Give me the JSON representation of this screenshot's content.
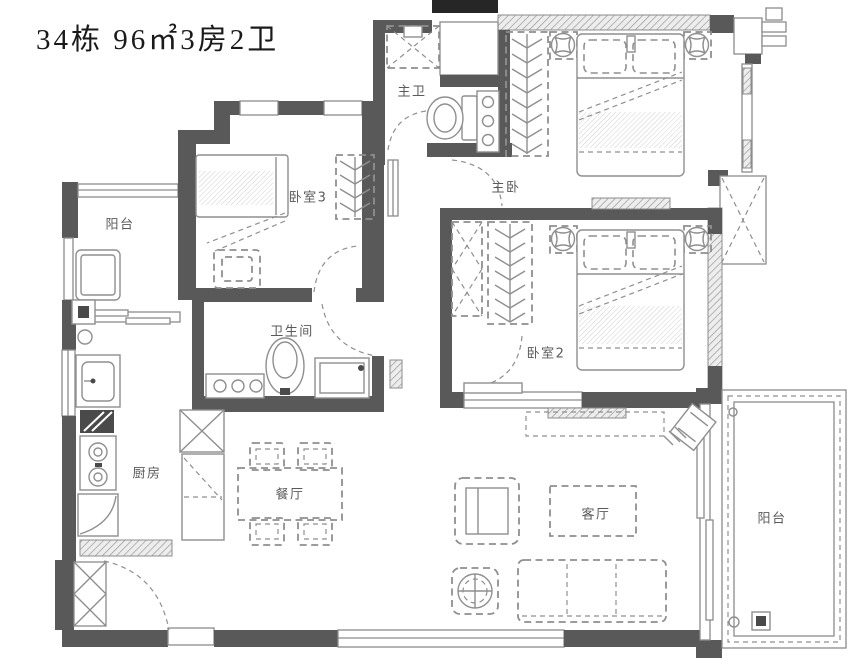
{
  "title": "34栋 96㎡3房2卫",
  "rooms": [
    {
      "name": "balcony-left",
      "label": "阳台"
    },
    {
      "name": "bedroom-3",
      "label": "卧室3"
    },
    {
      "name": "master-bathroom",
      "label": "主卫"
    },
    {
      "name": "master-bedroom",
      "label": "主卧"
    },
    {
      "name": "bathroom",
      "label": "卫生间"
    },
    {
      "name": "bedroom-2",
      "label": "卧室2"
    },
    {
      "name": "kitchen",
      "label": "厨房"
    },
    {
      "name": "dining-room",
      "label": "餐厅"
    },
    {
      "name": "living-room",
      "label": "客厅"
    },
    {
      "name": "balcony-right",
      "label": "阳台"
    }
  ],
  "colors": {
    "wall": "#595959",
    "wall_black": "#262626",
    "line": "#8c8c8c",
    "furniture": "#8f8f8f",
    "appliance_dark": "#4a4a4a",
    "label_text": "#5a5a5a",
    "title_text": "#1a1a1a"
  }
}
